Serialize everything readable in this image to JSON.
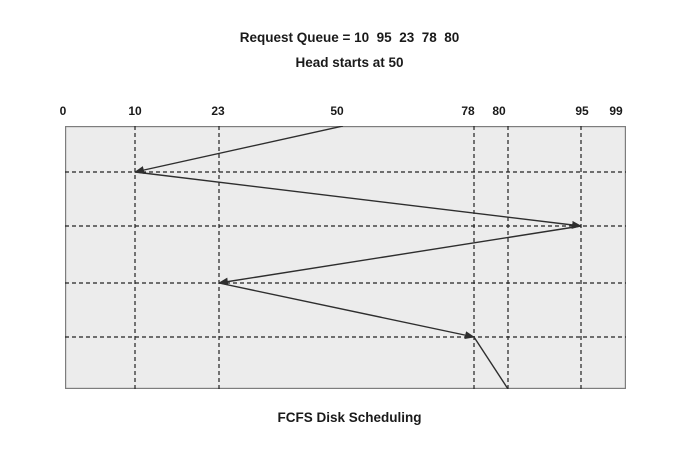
{
  "header": {
    "title_line1": "Request Queue = 10  95  23  78  80",
    "title_line2": "Head starts at 50"
  },
  "caption": "FCFS Disk Scheduling",
  "colors": {
    "page_background": "#ffffff",
    "chart_fill": "#ececec",
    "chart_border": "#7d7d7d",
    "grid_line": "#222222",
    "path_line": "#2e2e2e",
    "text": "#1a1a1a"
  },
  "chart_data": {
    "type": "line",
    "title": "FCFS Disk Scheduling",
    "subtitle": "Head starts at 50",
    "request_queue": [
      10,
      95,
      23,
      78,
      80
    ],
    "head_start": 50,
    "service_order": [
      50,
      10,
      95,
      23,
      78,
      80
    ],
    "x_axis_tick_labels": [
      "0",
      "10",
      "23",
      "50",
      "78",
      "80",
      "95",
      "99"
    ],
    "axis_range": [
      0,
      99
    ],
    "grid": "dashed",
    "legend": "none",
    "plot": {
      "width": 561,
      "height": 263,
      "ticks": [
        {
          "label": "0",
          "x": 0,
          "label_x": -2,
          "grid": false
        },
        {
          "label": "10",
          "x": 70,
          "label_x": 70,
          "grid": true
        },
        {
          "label": "23",
          "x": 154,
          "label_x": 153,
          "grid": true
        },
        {
          "label": "50",
          "x": 278,
          "label_x": 272,
          "grid": false
        },
        {
          "label": "78",
          "x": 409,
          "label_x": 403,
          "grid": true
        },
        {
          "label": "80",
          "x": 443,
          "label_x": 434,
          "grid": true
        },
        {
          "label": "95",
          "x": 516,
          "label_x": 517,
          "grid": true
        },
        {
          "label": "99",
          "x": 551,
          "label_x": 551,
          "grid": false
        }
      ],
      "h_gridlines_y": [
        46,
        100,
        157,
        211
      ],
      "path_points": [
        {
          "track": 50,
          "x": 278,
          "y": 0,
          "arrow": false
        },
        {
          "track": 10,
          "x": 70,
          "y": 46,
          "arrow": true
        },
        {
          "track": 95,
          "x": 516,
          "y": 100,
          "arrow": true
        },
        {
          "track": 23,
          "x": 154,
          "y": 157,
          "arrow": true
        },
        {
          "track": 78,
          "x": 409,
          "y": 211,
          "arrow": true
        },
        {
          "track": 80,
          "x": 443,
          "y": 263,
          "arrow": false
        }
      ]
    }
  }
}
